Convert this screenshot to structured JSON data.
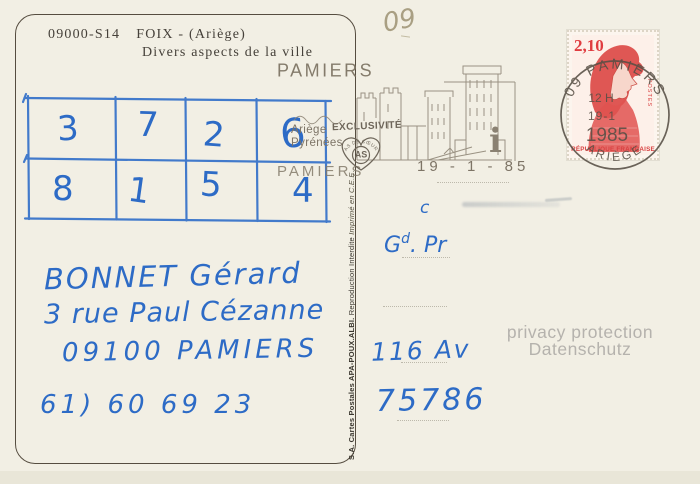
{
  "card": {
    "ref": "09000-S14",
    "title": "FOIX - (Ariège)",
    "subtitle": "Divers aspects de la ville",
    "pencil_note": "09",
    "publisher": {
      "part1": "S.A. Cartes Postales APA-POUX.ALBI.",
      "part2": " Reproduction Interdite ",
      "part3": "Imprimé en C.E.E."
    }
  },
  "grid": {
    "ink_color": "#2d6bc6",
    "row1": [
      "3",
      "7",
      "2",
      "6"
    ],
    "row2": [
      "8",
      "1",
      "5",
      "4"
    ]
  },
  "flamme": {
    "ink_color": "#847b6b",
    "town_top": "PAMIERS",
    "region_line1": "Ariège",
    "region_line2": "Pyrénées",
    "town_bottom": "PAMIERS",
    "date": "19 - 1 - 85",
    "info_symbol": "i",
    "overprint_line": "EXCLUSIVITÉ",
    "overprint_heart_arc": "AS DE CŒUR",
    "overprint_heart_center": "AS"
  },
  "stamp": {
    "value": "2,10",
    "country": "RÉPUBLIQUE FRANÇAISE",
    "postes": "POSTES",
    "red": "#e03c40"
  },
  "cancel": {
    "ink_color": "#574f45",
    "arc_top": "09 PAMIERS",
    "hour": "12 H",
    "day": "19-1",
    "year": "1985",
    "arc_bottom": "ARIÈGE"
  },
  "handwriting": {
    "ink_color": "#2d6bc6",
    "name": "BONNET Gérard",
    "street": "3 rue Paul Cézanne",
    "city": "09100 PAMIERS",
    "phone": "61) 60 69 23",
    "note_c": "c",
    "note_gd_main": "G",
    "note_gd_sup": "d",
    "note_gd_rest": ". Pr",
    "note_av": "116 Av",
    "note_num": "75786"
  },
  "watermark": {
    "line1": "privacy protection",
    "line2": "Datenschutz"
  }
}
